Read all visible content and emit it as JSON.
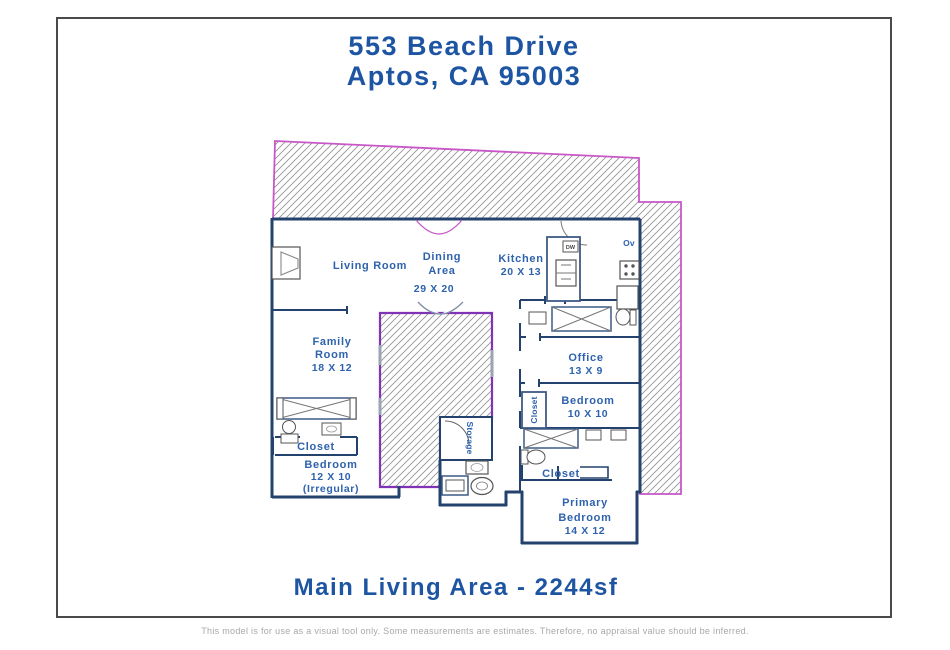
{
  "header": {
    "address_line1": "553 Beach Drive",
    "address_line2": "Aptos, CA 95003"
  },
  "footer": {
    "area_label": "Main Living Area - 2244sf",
    "disclaimer": "This model is for use as a visual tool only. Some measurements are estimates. Therefore, no appraisal value should be inferred."
  },
  "colors": {
    "title_blue": "#1d55a3",
    "room_label_blue": "#2e62ad",
    "wall_navy": "#24426e",
    "deck_border_magenta": "#c857c8",
    "courtyard_border_purple": "#8133b5",
    "hatch_gray": "#909090",
    "disclaimer_gray": "#a8a8a8"
  },
  "floorplan": {
    "labels": {
      "living_room": "Living Room",
      "dining_1": "Dining",
      "dining_2": "Area",
      "dining_dim": "29 X 20",
      "kitchen": "Kitchen",
      "kitchen_dim": "20 X 13",
      "oven": "Ov",
      "dishwasher": "DW",
      "family_1": "Family",
      "family_2": "Room",
      "family_dim": "18 X 12",
      "office": "Office",
      "office_dim": "13 X 9",
      "bedroom10": "Bedroom",
      "bedroom10_dim": "10 X 10",
      "closet_vertical": "Closet",
      "storage": "Storage",
      "closet_left": "Closet",
      "bedroom12": "Bedroom",
      "bedroom12_dim": "12 X 10",
      "bedroom12_note": "(Irregular)",
      "closet_right": "Closet",
      "primary_1": "Primary",
      "primary_2": "Bedroom",
      "primary_dim": "14 X 12"
    }
  }
}
